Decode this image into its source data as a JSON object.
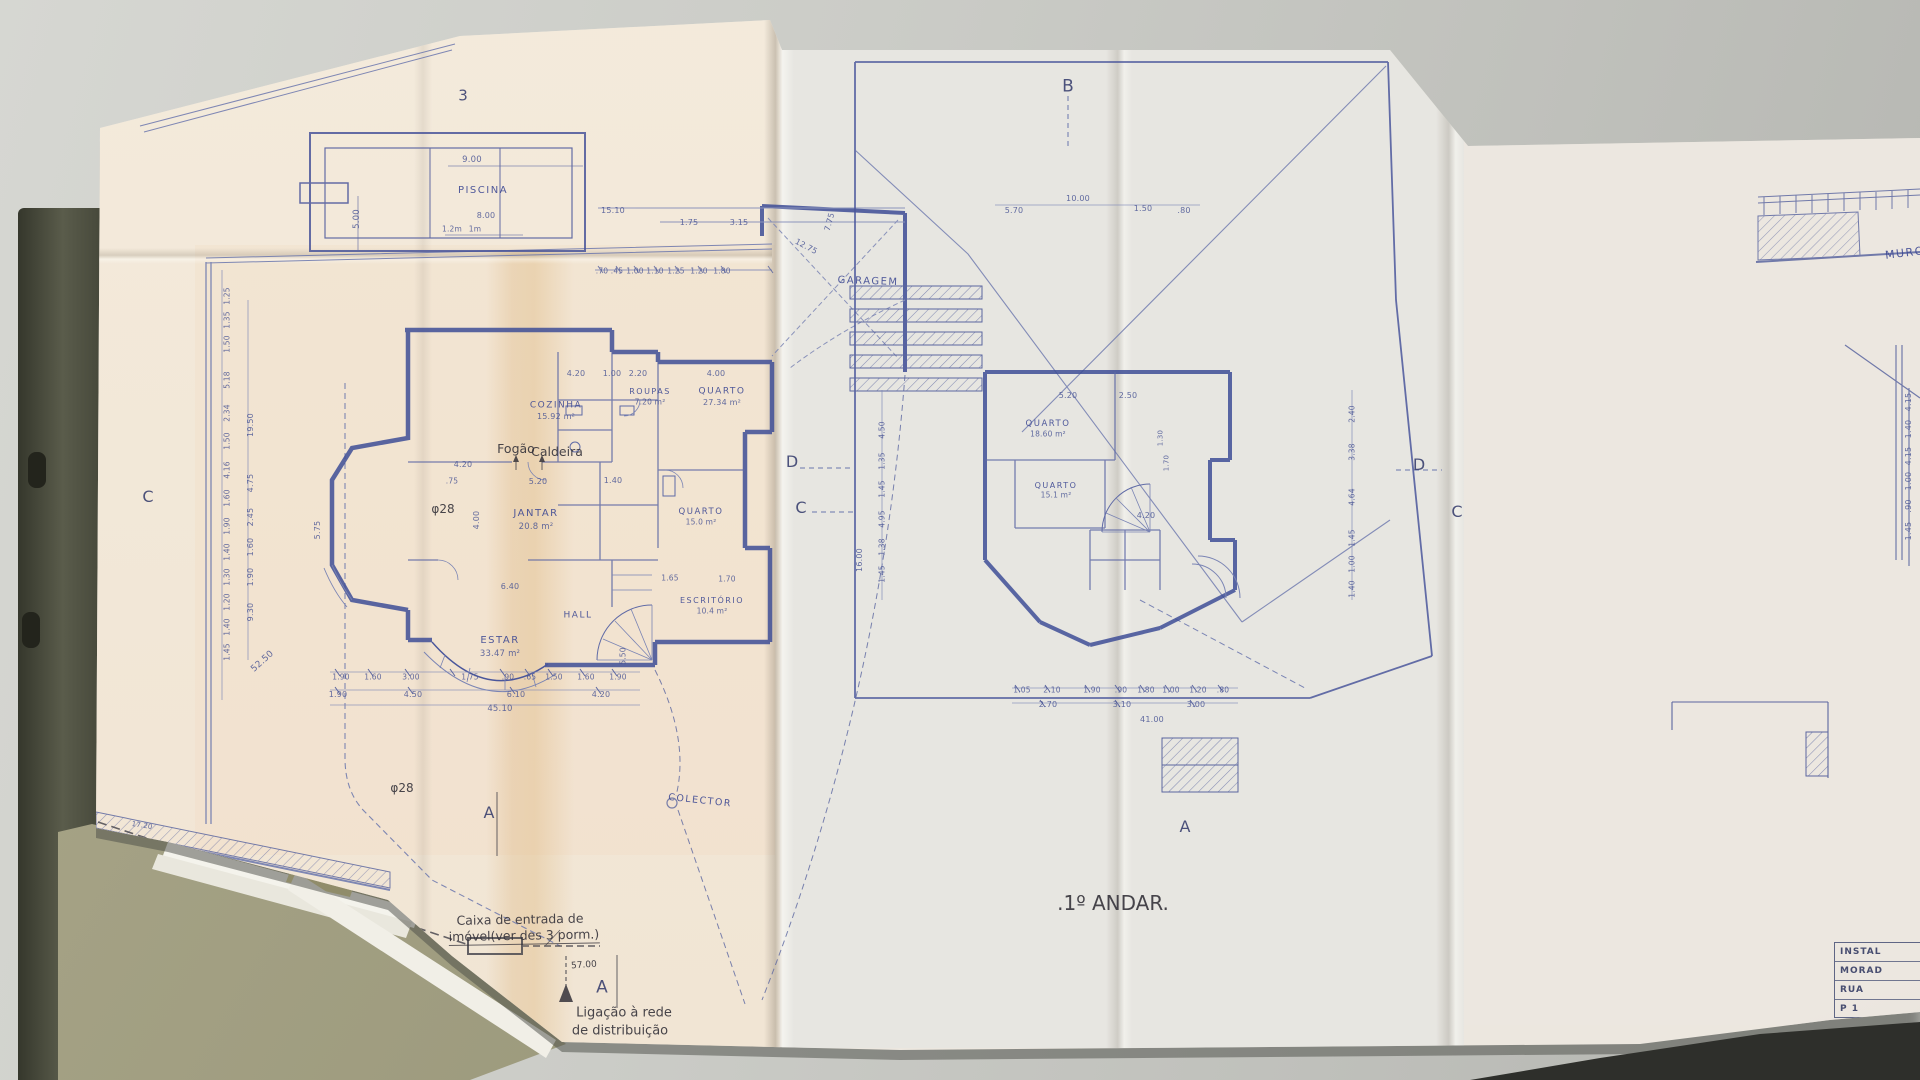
{
  "colors": {
    "desk": "#c8c9c4",
    "desk_edge": "#2e2f2b",
    "paper": "#ece7df",
    "paper_warm_tint": "#f3e4cf",
    "tape_stain": "#d9a864",
    "ink_blue": "#3e4d97",
    "ink_blue_light": "#6a76ad",
    "pencil": "#34323a",
    "binder": "#484a3c",
    "folder": "#a6a386"
  },
  "drawing": {
    "sheet_number": "3",
    "ground_floor_title": ".R/CHÃO.",
    "first_floor_title": ".1º ANDAR.",
    "ground_floor_rooms": [
      "PISCINA",
      "GARAGEM",
      "COZINHA 15.92 m²",
      "ROUPAS 7.20 m²",
      "QUARTO 27.34 m²",
      "JANTAR 20.8 m²",
      "ESTAR 33.47 m²",
      "HALL",
      "QUARTO 15.0 m²",
      "ESCRITÓRIO 10.4 m²"
    ],
    "first_floor_rooms": [
      "QUARTO 18.60 m²",
      "QUARTO 15.1 m²"
    ],
    "pencil_notes": [
      "Fogão",
      "Caldeira",
      "φ28",
      "Caixa de entrada de imóvel(ver des 3 porm.)",
      "Ligação à rede de distribuição",
      "COLECTOR",
      "MURO"
    ],
    "section_markers": [
      "A",
      "B",
      "C",
      "D"
    ]
  },
  "title_block": {
    "rows": [
      "INSTAL",
      "MORAD",
      "RUA",
      "P 1"
    ]
  },
  "labels": [
    [
      "sheet-number",
      "3",
      463,
      96,
      15,
      "m",
      0
    ],
    [
      "marker-b",
      "B",
      1068,
      87,
      17,
      "m",
      0
    ],
    [
      "marker-c-left",
      "C",
      148,
      497,
      16,
      "m",
      0
    ],
    [
      "marker-d-left",
      "D",
      792,
      462,
      16,
      "m",
      0
    ],
    [
      "marker-c-mid",
      "C",
      801,
      508,
      16,
      "m",
      0
    ],
    [
      "marker-d-right",
      "D",
      1419,
      465,
      16,
      "m",
      0
    ],
    [
      "marker-c-right",
      "C",
      1457,
      512,
      16,
      "m",
      0
    ],
    [
      "marker-a-left",
      "A",
      489,
      813,
      16,
      "m",
      0
    ],
    [
      "marker-a-mid",
      "A",
      602,
      988,
      17,
      "m",
      0
    ],
    [
      "marker-a-right",
      "A",
      1185,
      827,
      16,
      "m",
      0
    ],
    [
      "room-piscina",
      "PISCINA",
      483,
      191,
      10,
      "r",
      0
    ],
    [
      "room-garagem",
      "GARAGEM",
      868,
      282,
      10,
      "r",
      2
    ],
    [
      "room-cozinha",
      "COZINHA",
      556,
      406,
      9,
      "r",
      0
    ],
    [
      "area-cozinha",
      "15.92 m²",
      556,
      417,
      8,
      "d",
      0
    ],
    [
      "room-roupas",
      "ROUPAS",
      650,
      392,
      8,
      "r",
      0
    ],
    [
      "area-roupas",
      "7.20 m²",
      650,
      402,
      7.5,
      "d",
      0
    ],
    [
      "room-quarto-1",
      "QUARTO",
      722,
      392,
      9,
      "r",
      0
    ],
    [
      "area-quarto-1",
      "27.34 m²",
      722,
      403,
      8,
      "d",
      0
    ],
    [
      "room-jantar",
      "JANTAR",
      536,
      514,
      10,
      "r",
      0
    ],
    [
      "area-jantar",
      "20.8 m²",
      536,
      527,
      8.5,
      "d",
      0
    ],
    [
      "room-estar",
      "ESTAR",
      500,
      641,
      10,
      "r",
      0
    ],
    [
      "area-estar",
      "33.47 m²",
      500,
      654,
      8.5,
      "d",
      0
    ],
    [
      "room-hall",
      "HALL",
      578,
      616,
      9,
      "r",
      0
    ],
    [
      "room-quarto-2",
      "QUARTO",
      701,
      512,
      8.5,
      "r",
      0
    ],
    [
      "area-quarto-2",
      "15.0 m²",
      701,
      522,
      7.5,
      "d",
      0
    ],
    [
      "room-escritorio",
      "ESCRITÓRIO",
      712,
      601,
      8,
      "r",
      0
    ],
    [
      "area-escritorio",
      "10.4 m²",
      712,
      611,
      7.5,
      "d",
      0
    ],
    [
      "room-colector",
      "COLECTOR",
      700,
      801,
      9.5,
      "r",
      6
    ],
    [
      "room-quarto-f1",
      "QUARTO",
      1048,
      424,
      8.5,
      "r",
      0
    ],
    [
      "area-quarto-f1",
      "18.60 m²",
      1048,
      434,
      7.5,
      "d",
      0
    ],
    [
      "room-quarto-f2",
      "QUARTO",
      1056,
      486,
      8,
      "r",
      0
    ],
    [
      "area-quarto-f2",
      "15.1 m²",
      1056,
      495,
      7.5,
      "d",
      0
    ],
    [
      "title-ground-floor",
      ".R/CHÃO.",
      252,
      905,
      21,
      "p",
      -2
    ],
    [
      "title-first-floor",
      ".1º ANDAR.",
      1113,
      903,
      20,
      "p",
      0
    ],
    [
      "note-fogao",
      "Fogão",
      516,
      449,
      12.5,
      "p",
      0
    ],
    [
      "note-caldeira",
      "Caldeira",
      557,
      452,
      12.5,
      "p",
      0
    ],
    [
      "note-fi28-1",
      "φ28",
      443,
      509,
      12,
      "p",
      0
    ],
    [
      "note-fi28-2",
      "φ28",
      402,
      788,
      12,
      "p",
      0
    ],
    [
      "note-fi28-3",
      "φ28",
      416,
      957,
      12,
      "p",
      -4
    ],
    [
      "note-caixa-1",
      "Caixa de entrada de",
      520,
      920,
      12.5,
      "p",
      -1
    ],
    [
      "note-caixa-2",
      "imóvel(ver des 3 porm.)",
      524,
      937,
      12.5,
      "pu",
      -1
    ],
    [
      "note-ligacao-1",
      "Ligação à rede",
      624,
      1013,
      13,
      "p",
      0
    ],
    [
      "note-ligacao-2",
      "de distribuição",
      620,
      1031,
      13,
      "p",
      0
    ],
    [
      "note-muro",
      "MURO",
      1905,
      253,
      11,
      "r",
      -7
    ],
    [
      "dim-total-run",
      "57.00",
      584,
      966,
      9,
      "p",
      -4
    ],
    [
      "dim-label",
      "9.00",
      472,
      160,
      8.5,
      "d",
      0
    ],
    [
      "dim-label",
      "5.00",
      357,
      219,
      8.5,
      "d",
      -90
    ],
    [
      "dim-label",
      "1.2m",
      452,
      229,
      7.5,
      "d",
      0
    ],
    [
      "dim-label",
      "1m",
      475,
      229,
      7.5,
      "d",
      0
    ],
    [
      "dim-label",
      "8.00",
      486,
      216,
      8,
      "d",
      0
    ],
    [
      "dim-label",
      "15.10",
      613,
      211,
      8,
      "d",
      0
    ],
    [
      "dim-label",
      "1.75",
      689,
      223,
      8,
      "d",
      0
    ],
    [
      "dim-label",
      "3.15",
      739,
      223,
      8,
      "d",
      0
    ],
    [
      "dim-label",
      "7.75",
      830,
      222,
      8,
      "d",
      -75
    ],
    [
      "dim-label",
      "12.75",
      806,
      247,
      8,
      "d",
      28
    ],
    [
      "dim-label",
      ".70",
      602,
      271,
      7.5,
      "d",
      0
    ],
    [
      "dim-label",
      ".45",
      617,
      271,
      7.5,
      "d",
      0
    ],
    [
      "dim-label",
      "1.00",
      635,
      271,
      7.5,
      "d",
      0
    ],
    [
      "dim-label",
      "1.10",
      655,
      271,
      7.5,
      "d",
      0
    ],
    [
      "dim-label",
      "1.25",
      676,
      271,
      7.5,
      "d",
      0
    ],
    [
      "dim-label",
      "1.20",
      699,
      271,
      7.5,
      "d",
      0
    ],
    [
      "dim-label",
      "1.80",
      722,
      271,
      7.5,
      "d",
      0
    ],
    [
      "dim-label",
      "4.20",
      576,
      374,
      8,
      "d",
      0
    ],
    [
      "dim-label",
      "1.00",
      612,
      374,
      8,
      "d",
      0
    ],
    [
      "dim-label",
      "2.20",
      638,
      374,
      8,
      "d",
      0
    ],
    [
      "dim-label",
      "4.00",
      716,
      374,
      8,
      "d",
      0
    ],
    [
      "dim-label",
      "4.20",
      463,
      465,
      8,
      "d",
      0
    ],
    [
      "dim-label",
      ".75",
      452,
      481,
      7.5,
      "d",
      0
    ],
    [
      "dim-label",
      "5.20",
      538,
      482,
      8,
      "d",
      0
    ],
    [
      "dim-label",
      "1.40",
      613,
      481,
      8,
      "d",
      0
    ],
    [
      "dim-label",
      "4.00",
      477,
      520,
      8,
      "d",
      -90
    ],
    [
      "dim-label",
      "6.40",
      510,
      587,
      8,
      "d",
      0
    ],
    [
      "dim-label",
      "1.65",
      670,
      578,
      7.5,
      "d",
      0
    ],
    [
      "dim-label",
      "1.70",
      727,
      579,
      7.5,
      "d",
      0
    ],
    [
      "dim-label",
      "5.50",
      623,
      656,
      7.5,
      "d",
      -90
    ],
    [
      "dim-label",
      "1.90",
      341,
      677,
      7.5,
      "d",
      0
    ],
    [
      "dim-label",
      "1.60",
      373,
      677,
      7.5,
      "d",
      0
    ],
    [
      "dim-label",
      "3.00",
      411,
      677,
      7.5,
      "d",
      0
    ],
    [
      "dim-label",
      "1.75",
      470,
      677,
      7.5,
      "d",
      0
    ],
    [
      "dim-label",
      ".90",
      508,
      677,
      7.5,
      "d",
      0
    ],
    [
      "dim-label",
      ".65",
      530,
      677,
      7.5,
      "d",
      0
    ],
    [
      "dim-label",
      "1.50",
      554,
      677,
      7.5,
      "d",
      0
    ],
    [
      "dim-label",
      "1.60",
      586,
      677,
      7.5,
      "d",
      0
    ],
    [
      "dim-label",
      "1.90",
      618,
      677,
      7.5,
      "d",
      0
    ],
    [
      "dim-label",
      "1.90",
      338,
      695,
      8,
      "d",
      0
    ],
    [
      "dim-label",
      "4.50",
      413,
      695,
      8,
      "d",
      0
    ],
    [
      "dim-label",
      "6.10",
      516,
      695,
      8,
      "d",
      0
    ],
    [
      "dim-label",
      "4.20",
      601,
      695,
      8,
      "d",
      0
    ],
    [
      "dim-label",
      "45.10",
      500,
      709,
      8.5,
      "d",
      0
    ],
    [
      "dim-label",
      "17.20",
      142,
      826,
      7,
      "d",
      9
    ],
    [
      "dim-label",
      "1.25",
      227,
      296,
      7.5,
      "d",
      -90
    ],
    [
      "dim-label",
      "1.35",
      227,
      320,
      7.5,
      "d",
      -90
    ],
    [
      "dim-label",
      "1.50",
      227,
      344,
      7.5,
      "d",
      -90
    ],
    [
      "dim-label",
      "5.18",
      227,
      380,
      7.5,
      "d",
      -90
    ],
    [
      "dim-label",
      "2.34",
      227,
      413,
      7.5,
      "d",
      -90
    ],
    [
      "dim-label",
      "1.50",
      227,
      441,
      7.5,
      "d",
      -90
    ],
    [
      "dim-label",
      "4.16",
      227,
      470,
      7.5,
      "d",
      -90
    ],
    [
      "dim-label",
      "1.60",
      227,
      498,
      7.5,
      "d",
      -90
    ],
    [
      "dim-label",
      "1.90",
      227,
      526,
      7.5,
      "d",
      -90
    ],
    [
      "dim-label",
      "1.40",
      227,
      552,
      7.5,
      "d",
      -90
    ],
    [
      "dim-label",
      "1.30",
      227,
      577,
      7.5,
      "d",
      -90
    ],
    [
      "dim-label",
      "1.20",
      227,
      602,
      7.5,
      "d",
      -90
    ],
    [
      "dim-label",
      "1.40",
      227,
      627,
      7.5,
      "d",
      -90
    ],
    [
      "dim-label",
      "1.45",
      227,
      652,
      7.5,
      "d",
      -90
    ],
    [
      "dim-label",
      "19.50",
      251,
      425,
      8,
      "d",
      -90
    ],
    [
      "dim-label",
      "4.75",
      251,
      483,
      8,
      "d",
      -90
    ],
    [
      "dim-label",
      "2.45",
      251,
      517,
      8,
      "d",
      -90
    ],
    [
      "dim-label",
      "1.60",
      251,
      547,
      8,
      "d",
      -90
    ],
    [
      "dim-label",
      "1.90",
      251,
      577,
      8,
      "d",
      -90
    ],
    [
      "dim-label",
      "9.30",
      251,
      612,
      8,
      "d",
      -90
    ],
    [
      "dim-label",
      "52.50",
      263,
      662,
      9,
      "d",
      -42
    ],
    [
      "dim-label",
      "5.75",
      318,
      530,
      8,
      "d",
      -90
    ],
    [
      "dim-label",
      "10.00",
      1078,
      199,
      8,
      "d",
      0
    ],
    [
      "dim-label",
      "5.70",
      1014,
      211,
      8,
      "d",
      0
    ],
    [
      "dim-label",
      "1.50",
      1143,
      209,
      8,
      "d",
      0
    ],
    [
      "dim-label",
      ".80",
      1184,
      211,
      8,
      "d",
      0
    ],
    [
      "dim-label",
      "4.50",
      882,
      430,
      7.5,
      "d",
      -90
    ],
    [
      "dim-label",
      "1.35",
      882,
      461,
      7.5,
      "d",
      -90
    ],
    [
      "dim-label",
      "1.45",
      882,
      489,
      7.5,
      "d",
      -90
    ],
    [
      "dim-label",
      "4.95",
      882,
      519,
      7.5,
      "d",
      -90
    ],
    [
      "dim-label",
      "1.38",
      882,
      547,
      7.5,
      "d",
      -90
    ],
    [
      "dim-label",
      "1.45",
      882,
      574,
      7.5,
      "d",
      -90
    ],
    [
      "dim-label",
      "16.00",
      860,
      560,
      8,
      "d",
      -90
    ],
    [
      "dim-label",
      "2.40",
      1352,
      414,
      7.5,
      "d",
      -90
    ],
    [
      "dim-label",
      "3.38",
      1352,
      452,
      7.5,
      "d",
      -90
    ],
    [
      "dim-label",
      "4.64",
      1352,
      497,
      7.5,
      "d",
      -90
    ],
    [
      "dim-label",
      "1.45",
      1352,
      538,
      7.5,
      "d",
      -90
    ],
    [
      "dim-label",
      "1.00",
      1352,
      564,
      7.5,
      "d",
      -90
    ],
    [
      "dim-label",
      "1.40",
      1352,
      589,
      7.5,
      "d",
      -90
    ],
    [
      "dim-label",
      "5.20",
      1068,
      396,
      8,
      "d",
      0
    ],
    [
      "dim-label",
      "2.50",
      1128,
      396,
      8,
      "d",
      0
    ],
    [
      "dim-label",
      "4.20",
      1146,
      516,
      8,
      "d",
      0
    ],
    [
      "dim-label",
      "1.30",
      1161,
      438,
      7,
      "d",
      -90
    ],
    [
      "dim-label",
      "1.70",
      1167,
      463,
      7,
      "d",
      -90
    ],
    [
      "dim-label",
      "1.05",
      1022,
      690,
      7.5,
      "d",
      0
    ],
    [
      "dim-label",
      "2.10",
      1052,
      690,
      7.5,
      "d",
      0
    ],
    [
      "dim-label",
      "1.90",
      1092,
      690,
      7.5,
      "d",
      0
    ],
    [
      "dim-label",
      ".90",
      1121,
      690,
      7.5,
      "d",
      0
    ],
    [
      "dim-label",
      "1.80",
      1146,
      690,
      7.5,
      "d",
      0
    ],
    [
      "dim-label",
      "1.00",
      1171,
      690,
      7.5,
      "d",
      0
    ],
    [
      "dim-label",
      "1.20",
      1198,
      690,
      7.5,
      "d",
      0
    ],
    [
      "dim-label",
      ".80",
      1223,
      690,
      7.5,
      "d",
      0
    ],
    [
      "dim-label",
      "2.70",
      1048,
      705,
      8,
      "d",
      0
    ],
    [
      "dim-label",
      "3.10",
      1122,
      705,
      8,
      "d",
      0
    ],
    [
      "dim-label",
      "3.00",
      1196,
      705,
      8,
      "d",
      0
    ],
    [
      "dim-label",
      "41.00",
      1152,
      720,
      8,
      "d",
      0
    ],
    [
      "dim-label",
      "4.15",
      1909,
      402,
      8,
      "d",
      -90
    ],
    [
      "dim-label",
      "1.40",
      1909,
      429,
      8,
      "d",
      -90
    ],
    [
      "dim-label",
      "4.15",
      1909,
      456,
      8,
      "d",
      -90
    ],
    [
      "dim-label",
      "1.00",
      1909,
      481,
      8,
      "d",
      -90
    ],
    [
      "dim-label",
      ".90",
      1909,
      506,
      8,
      "d",
      -90
    ],
    [
      "dim-label",
      "1.45",
      1909,
      531,
      8,
      "d",
      -90
    ]
  ]
}
